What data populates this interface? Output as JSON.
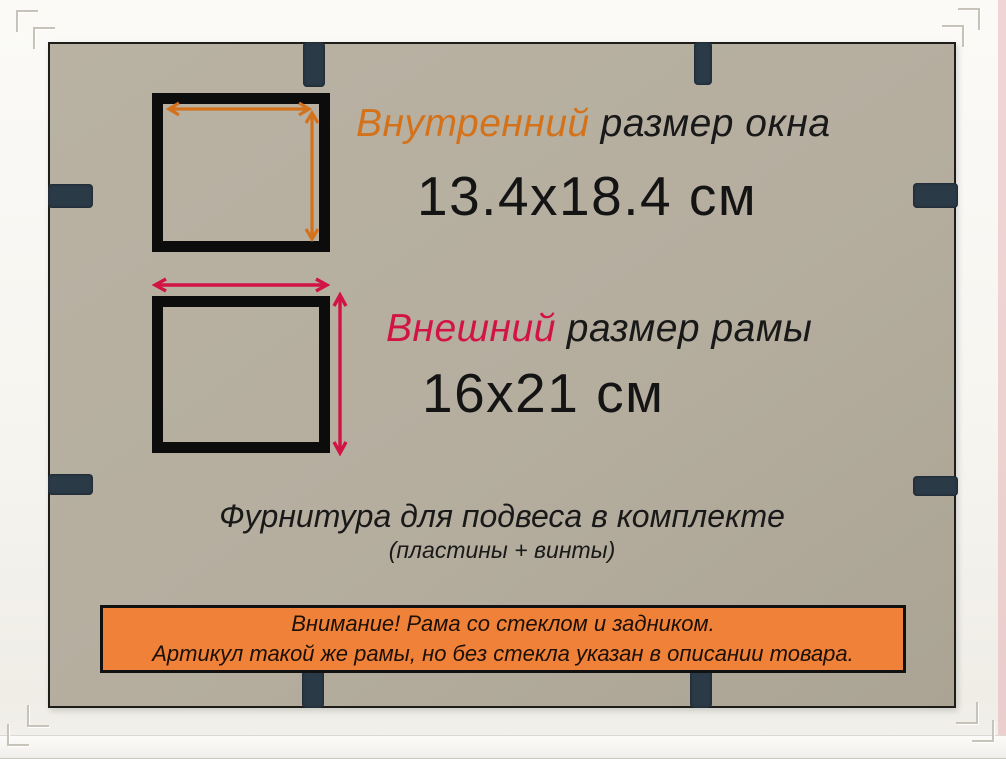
{
  "product_card": {
    "inner": {
      "highlight": "Внутренний",
      "rest": "размер окна",
      "value": "13.4x18.4 см"
    },
    "outer": {
      "highlight": "Внешний",
      "rest": "размер рамы",
      "value": "16x21 см"
    },
    "hardware": {
      "title": "Фурнитура для подвеса в комплекте",
      "subtitle": "(пластины + винты)"
    },
    "notice": {
      "line1": "Внимание! Рама со стеклом и задником.",
      "line2": "Артикул такой же рамы, но без стекла указан в описании товара."
    }
  },
  "colors": {
    "inner_accent": "#d4721c",
    "outer_accent": "#d11345",
    "notice_bg": "#f08138",
    "board_bg": "#b5ae9f",
    "clip": "#2b3a47"
  },
  "icons": {
    "measure_horizontal": "double-arrow-horizontal",
    "measure_vertical": "double-arrow-vertical",
    "clip": "frame-flexible-tab",
    "corner": "frame-corner-joint"
  }
}
